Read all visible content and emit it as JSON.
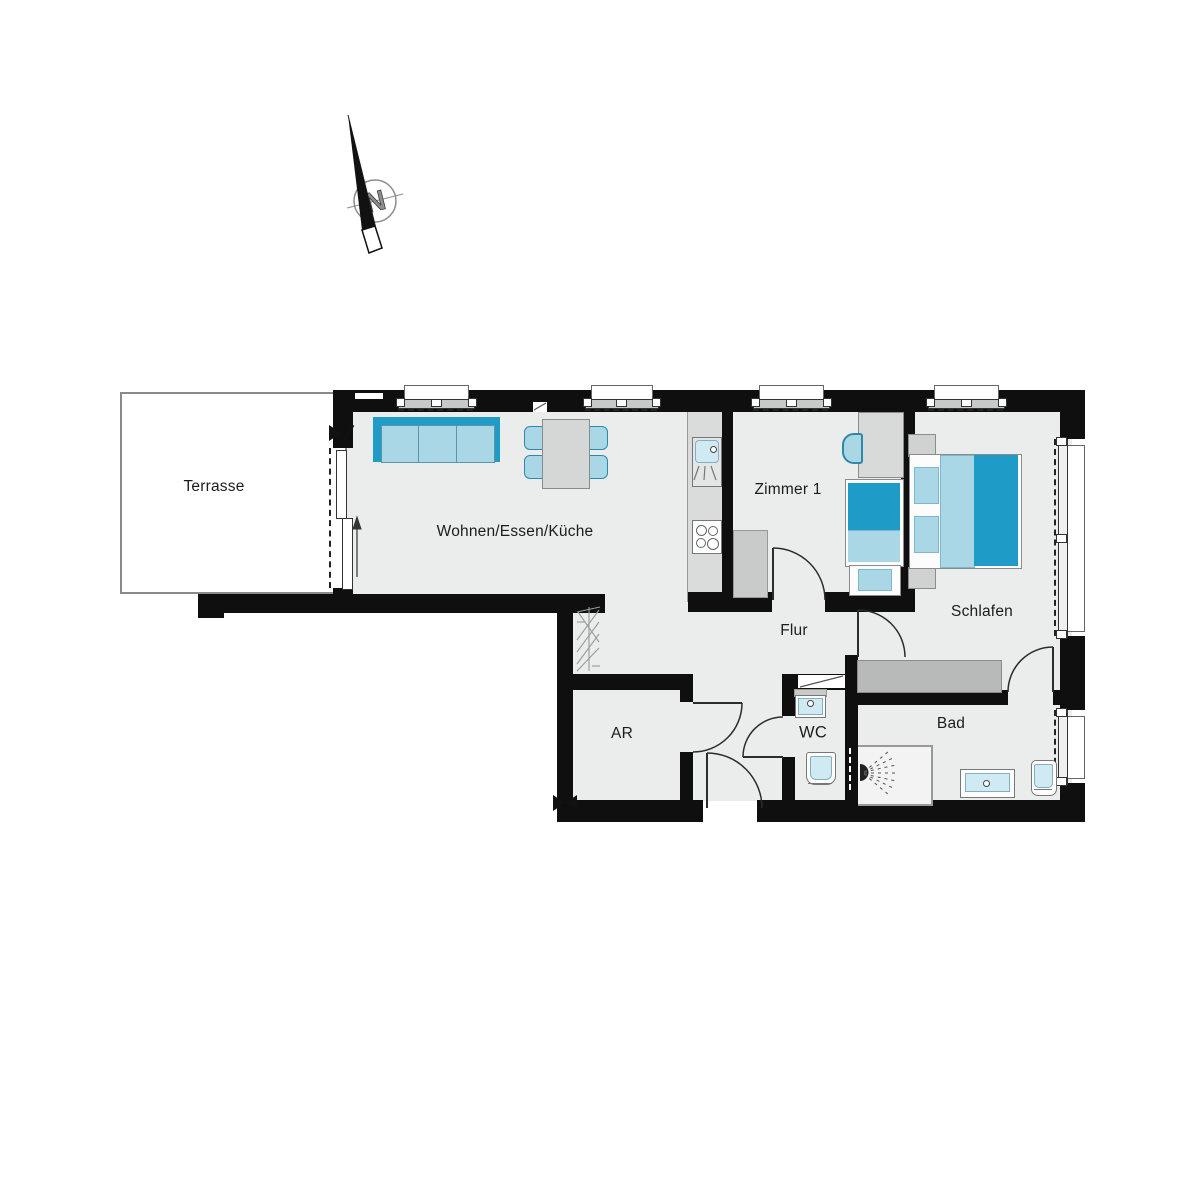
{
  "compass": {
    "north_label": "N"
  },
  "rooms": [
    {
      "id": "terrasse",
      "label": "Terrasse"
    },
    {
      "id": "wohnen-essen-kueche",
      "label": "Wohnen/Essen/Küche"
    },
    {
      "id": "zimmer-1",
      "label": "Zimmer 1"
    },
    {
      "id": "schlafen",
      "label": "Schlafen"
    },
    {
      "id": "flur",
      "label": "Flur"
    },
    {
      "id": "ar",
      "label": "AR"
    },
    {
      "id": "wc",
      "label": "WC"
    },
    {
      "id": "bad",
      "label": "Bad"
    }
  ],
  "colors": {
    "wall": "#0f0f0f",
    "floor": "#ebecec",
    "terrace_fill": "#ffffff",
    "furniture_gray": "#d5d6d6",
    "sideboard_gray": "#b8b9b9",
    "counter_gray": "#dadbdb",
    "teal": "#1e9cc7",
    "cyan": "#a9d7e6",
    "fixture_cyan": "#cfeaf3"
  }
}
